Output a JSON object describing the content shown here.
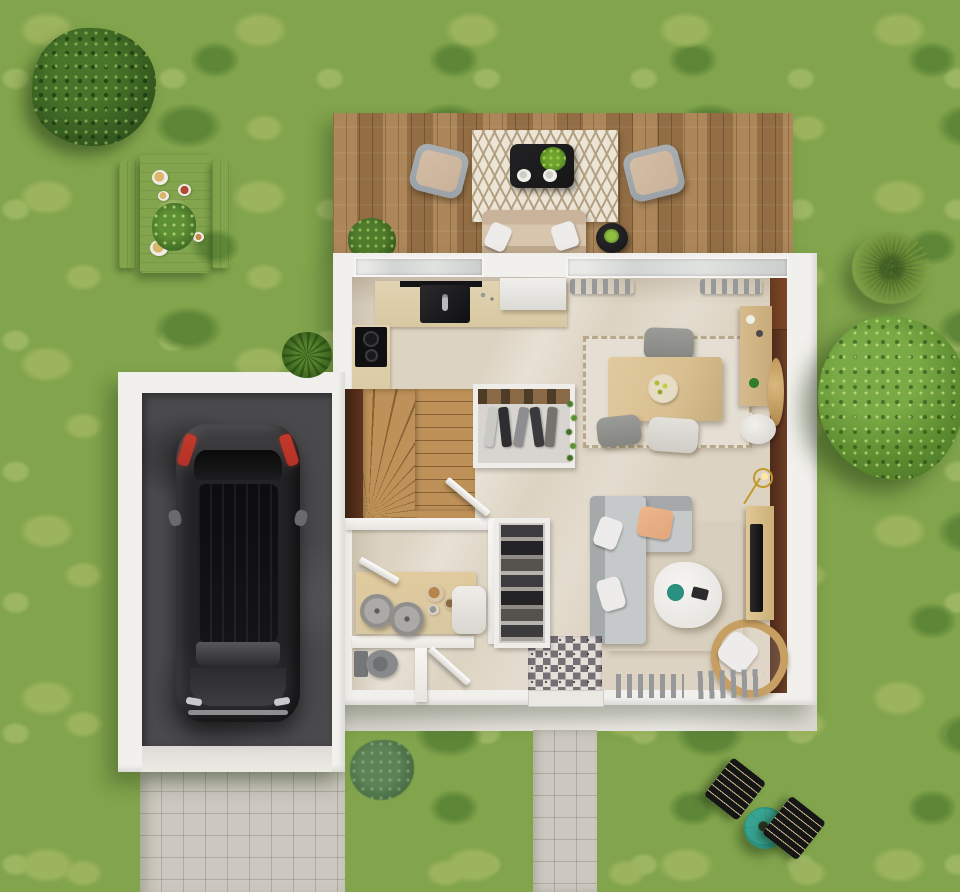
{
  "scene": {
    "description": "Top-down 3D rendered ground-floor plan of a single-family house with garden, wooden terrace, garage with parked car, lawn, paths and outdoor furniture",
    "view": "top-down",
    "width_px": 960,
    "height_px": 892
  },
  "colors": {
    "grass": "#81a44c",
    "grass_light": "#9db45e",
    "grass_dark": "#5e8637",
    "bush_dark": "#33571f",
    "deck_wood": "#a47c4f",
    "wall_white": "#f2f0ec",
    "floor_beige": "#ddd3c2",
    "accent_brown": "#5e3420",
    "door_brown": "#7d4627",
    "garage_concrete": "#4a4a4d",
    "taillight_red": "#b23227",
    "path_gray": "#ccc8c0",
    "apron_gray": "#e6e3dd",
    "stairs_wood": "#bd9157",
    "counter_wood": "#d8c8a2",
    "table_wood": "#d8bf90",
    "sideboard_wood": "#c8ab7a",
    "rug_cream": "#ece5d6",
    "rug_pattern": "#b3a183",
    "rug_dining": "#e5dfd3",
    "rug_living": "#d8cfbe",
    "sofa_gray": "#b4b7b8",
    "sofa_seat": "#c6c9c9",
    "pillow_white": "#edecea",
    "pillow_peach": "#e2a67c",
    "armchair_frame": "#9ba2a7",
    "armchair_cushion": "#cab29a",
    "black_furniture": "#161617",
    "teal": "#2a9181",
    "fruit_green": "#aebc33",
    "fin_gray": "#97989a",
    "toilet_gray": "#87898a",
    "gold": "#c19a2e",
    "rattan": "#c79f62",
    "lounger_black": "#151515",
    "tile_dark": "#6e6870",
    "tile_light": "#e6e2dc"
  },
  "areas": {
    "garden": [
      "lawn",
      "large bush top-left",
      "white picnic table with two benches and tableware",
      "large leafy tree on the right",
      "ornamental spiky grass",
      "two black sun loungers",
      "teal parasol",
      "shrub rows along front path",
      "teal bush near entrance"
    ],
    "terrace": [
      "wooden deck",
      "chevron rug",
      "black coffee table with plant and plates",
      "two gray-framed armchairs with beige cushions",
      "outdoor sofa with white pillows",
      "round black side table",
      "potted plant"
    ],
    "house_rooms": [
      "kitchen with L-shaped counter, sink, cooktop and fridge",
      "dining room with wooden table, chairs, rug, sideboard, wall mirror, pouf and floor lamp",
      "living room with gray sectional sofa, white coffee table, rattan chair, TV console and radiators",
      "hall with winder staircase and wardrobe",
      "utility room with counter, baskets and stool",
      "wc with toilet",
      "entrance with patterned cement tiles"
    ],
    "garage": [
      "dark concrete floor",
      "black car parked facing the driveway"
    ],
    "paving": [
      "front footpath",
      "garage driveway",
      "concrete apron along house"
    ]
  }
}
